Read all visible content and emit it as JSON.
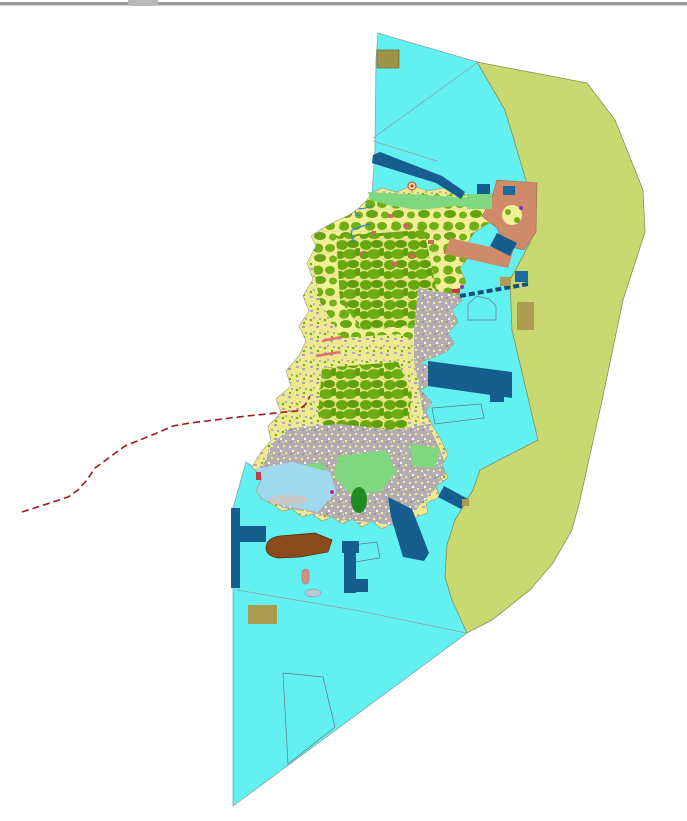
{
  "window": {
    "top_border": "window edge line",
    "tab_artifact": "small gray fragment at top center"
  },
  "map": {
    "background": "#FFFFFF",
    "palette": {
      "sea": "#63F0F0",
      "sea_stroke": "#7FA8A8",
      "zone_east": "#C9D971",
      "zone_east_stroke": "#8A9058",
      "island_base": "#EEE98E",
      "island_stroke": "#9A9A7A",
      "forest_green": "#6FAE15",
      "forest_dense": "#5F9E0E",
      "coast_green": "#7FD87F",
      "urban_gray": "#B3ADB3",
      "shallow_blue": "#9FD9EE",
      "salmon": "#CF8A6A",
      "salmon_stroke": "#A06A4A",
      "deep_blue": "#155E8E",
      "navy": "#1A6AA0",
      "khaki": "#AC9C52",
      "khaki_dark": "#9E9448",
      "brown": "#8A4A1C",
      "brown_stroke": "#5A2A08",
      "route_red": "#9E1B1B",
      "road_pink": "#E07070",
      "marker_red": "#CC3333",
      "red_patch": "#CC6655",
      "parcel_outline": "#667788",
      "boundary_gray": "#8AA0A0",
      "sand": "#C8C8C8",
      "islet_gray": "#B8C8D0",
      "islet_pink": "#D09080",
      "dark_green": "#1F8A1F",
      "magenta": "#CC2288",
      "stream_blue": "#2B7FD4"
    },
    "layers": [
      {
        "name": "sea-polygon",
        "fill": "sea",
        "description": "large cyan coastal water body"
      },
      {
        "name": "eastern-zone-polygon",
        "fill": "zone_east",
        "description": "olive-green offshore zone along east edge"
      },
      {
        "name": "island-landuse",
        "fill": "island_base",
        "description": "detailed island with forest, urban and coastal parcels"
      },
      {
        "name": "offshore-structures",
        "fill": "deep_blue",
        "description": "piers, harbor bands and marine structures"
      },
      {
        "name": "dashed-route",
        "fill": "route_red",
        "style": "dashed",
        "description": "red dashed boundary line running southwest"
      }
    ]
  }
}
